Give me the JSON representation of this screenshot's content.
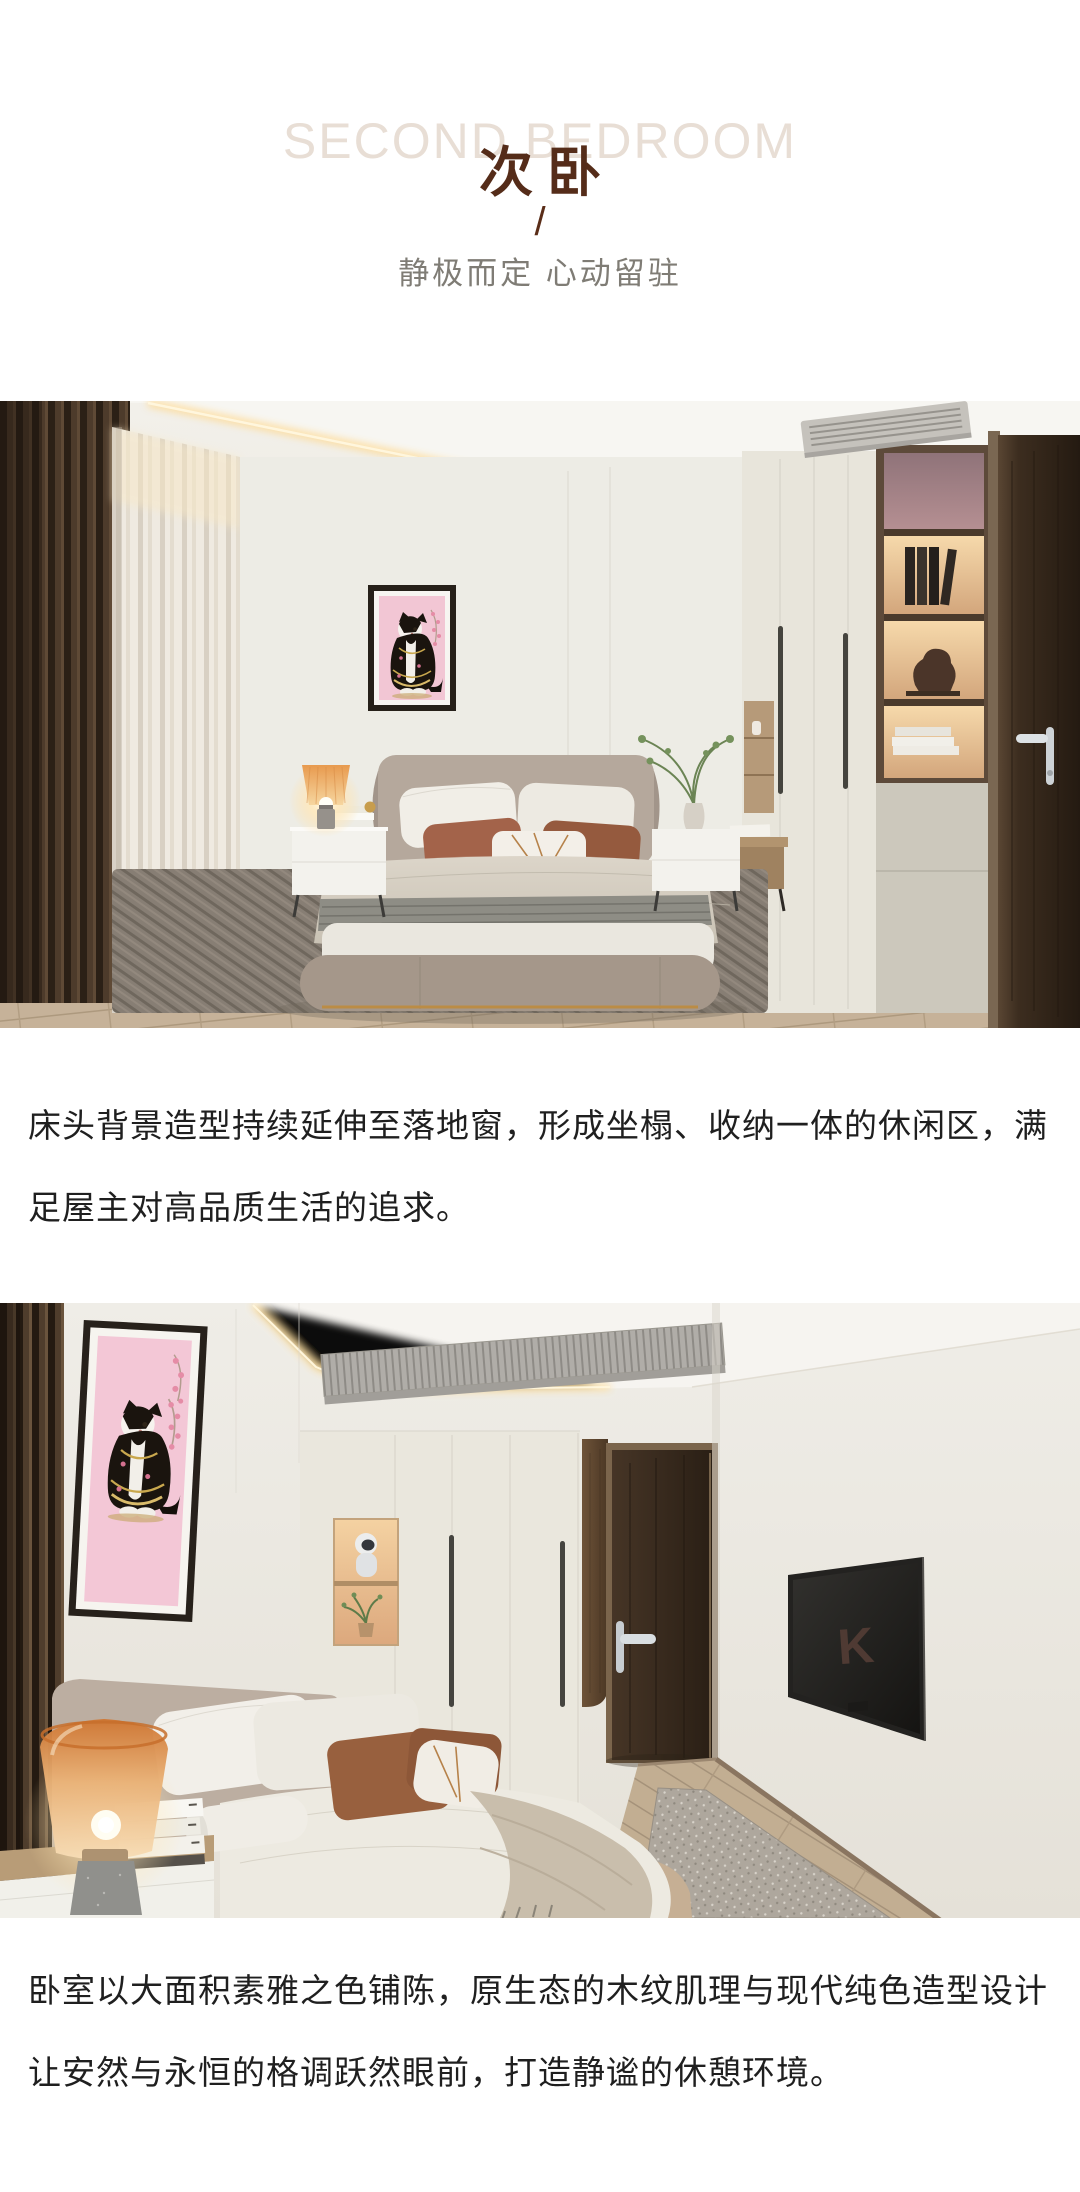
{
  "header": {
    "watermark": "SECOND BEDROOM",
    "title": "次卧",
    "divider": "/",
    "subtitle": "静极而定 心动留驻"
  },
  "paragraphs": {
    "p1": {
      "full": "床头背景造型持续延伸至落地窗，形成坐榻、收纳一体的休闲区，满足屋主对高品质生活的追求。",
      "lines": [
        "床头背景造型持续延伸至落地窗，形成坐榻、收纳一体的休闲区，满",
        "足屋主对高品质生活的追求。"
      ]
    },
    "p2": {
      "full": "卧室以大面积素雅之色铺陈，原生态的木纹肌理与现代纯色造型设计让安然与永恒的格调跃然眼前，打造静谧的休憩环境。",
      "lines": [
        "卧室以大面积素雅之色铺陈，原生态的木纹肌理与现代纯色造型设计",
        "让安然与永恒的格调跃然眼前，打造静谧的休憩环境。"
      ]
    }
  },
  "photos": {
    "photo2_tv_logo": "K"
  },
  "palette": {
    "title_brown": "#552c19",
    "watermark_gray": "#e8ded5",
    "subtitle_gray": "#7f7c75",
    "body_text": "#1f1f1f",
    "art_pink": "#f2c6d4",
    "accent_rust": "#a0613f",
    "warm_glow": "#f6d9ab",
    "walnut_dark": "#3c2d1f"
  }
}
